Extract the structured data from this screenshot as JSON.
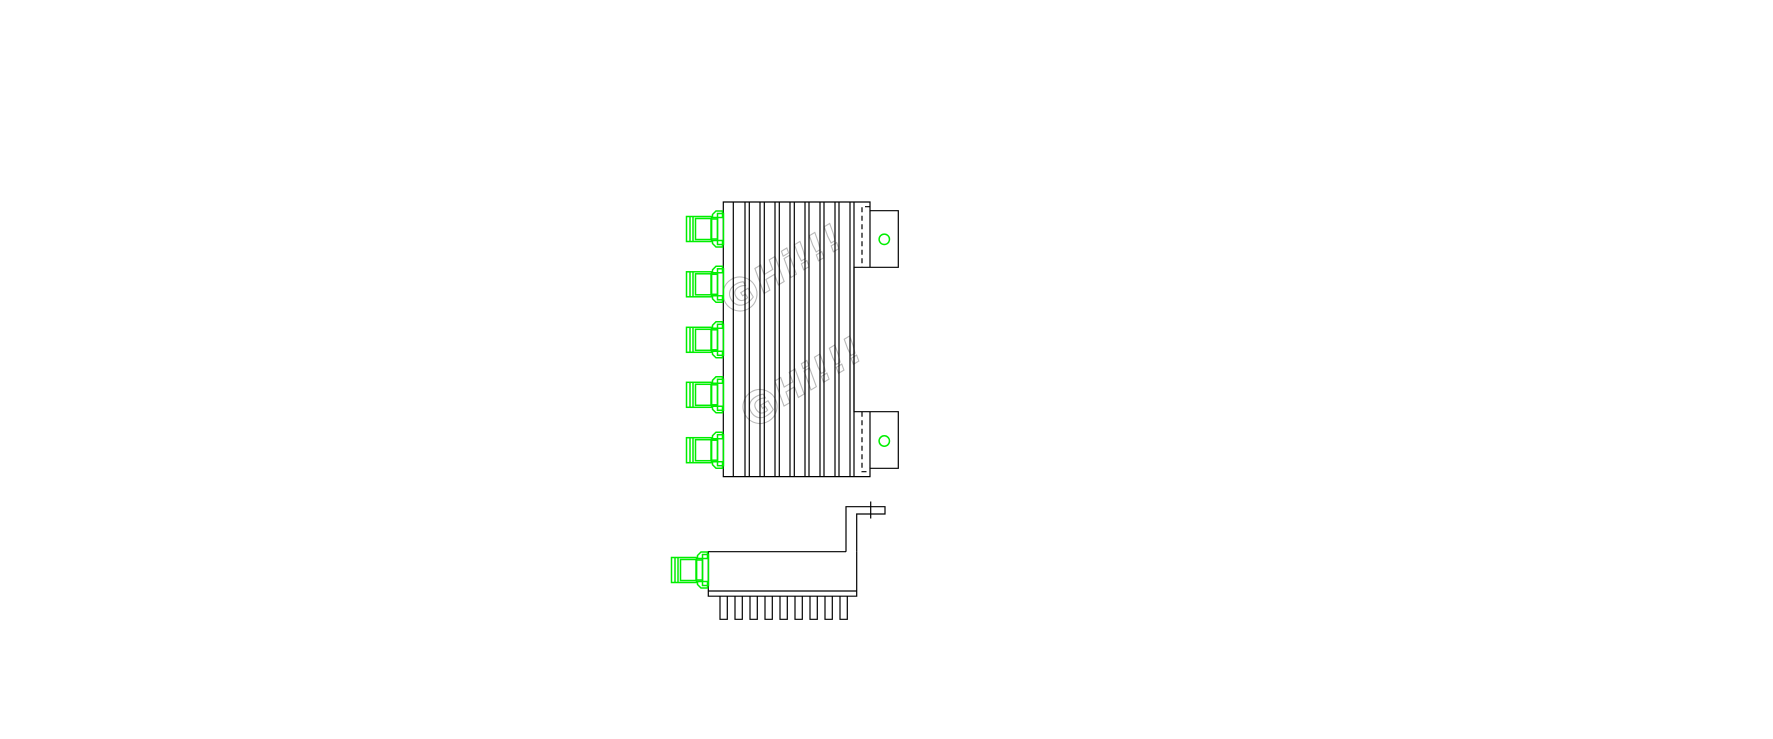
{
  "canvas": {
    "width": 1773,
    "height": 739,
    "background": "#ffffff"
  },
  "drawing": {
    "stroke": "#000000",
    "accent": "#00ee00",
    "watermark": {
      "monogram": "G",
      "text": "Hi!!!",
      "color": "#b9b9b9",
      "instances": 2
    },
    "top_view": {
      "connector_count": 5,
      "fin_line_count": 17,
      "mounting_tab_count": 2,
      "mounting_hole_count": 2
    },
    "side_view": {
      "connector_count": 1,
      "fin_count": 9,
      "bracket_count": 1
    }
  }
}
